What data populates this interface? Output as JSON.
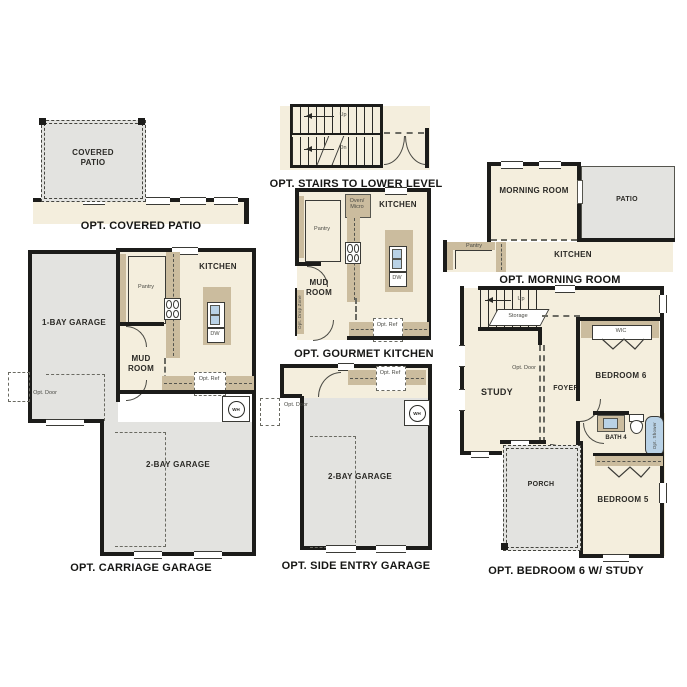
{
  "colors": {
    "room_fill": "#f4eedd",
    "garage_fill": "#e3e3e0",
    "counter_fill": "#cbbc9e",
    "wall": "#1c1c1a",
    "fixture_blue": "#b9d2e6",
    "text": "#2b2a26",
    "background": "#ffffff"
  },
  "plans": {
    "covered_patio": {
      "caption": "OPT. COVERED PATIO",
      "patio_label": "COVERED PATIO"
    },
    "stairs_lower": {
      "caption": "OPT. STAIRS TO LOWER LEVEL",
      "up": "Up",
      "dn": "Dn"
    },
    "morning_room": {
      "caption": "OPT. MORNING ROOM",
      "morning": "MORNING ROOM",
      "patio": "PATIO",
      "kitchen": "KITCHEN",
      "pantry": "Pantry"
    },
    "carriage_garage": {
      "caption": "OPT. CARRIAGE GARAGE",
      "garage1": "1-BAY GARAGE",
      "garage2": "2-BAY GARAGE",
      "kitchen": "KITCHEN",
      "pantry": "Pantry",
      "mud_room": "MUD ROOM",
      "opt_door": "Opt. Door",
      "opt_ref": "Opt. Ref",
      "dw": "DW",
      "wh": "WH"
    },
    "gourmet_kitchen": {
      "caption": "OPT. GOURMET KITCHEN",
      "kitchen": "KITCHEN",
      "pantry": "Pantry",
      "mud_room": "MUD ROOM",
      "oven_micro": "Oven/ Micro",
      "opt_ref": "Opt. Ref",
      "opt_drop_zone": "Opt. Drop Zone",
      "dw": "DW"
    },
    "side_entry_garage": {
      "caption": "OPT. SIDE ENTRY GARAGE",
      "garage": "2-BAY GARAGE",
      "opt_door": "Opt. Door",
      "opt_ref": "Opt. Ref",
      "wh": "WH"
    },
    "bedroom6_study": {
      "caption": "OPT. BEDROOM 6 W/ STUDY",
      "study": "STUDY",
      "foyer": "FOYER",
      "bedroom6": "BEDROOM 6",
      "bedroom5": "BEDROOM 5",
      "bath": "BATH 4",
      "wic": "WIC",
      "porch": "PORCH",
      "storage": "Storage",
      "up": "Up",
      "opt_door": "Opt. Door",
      "opt_shower": "Opt. Shower"
    }
  }
}
